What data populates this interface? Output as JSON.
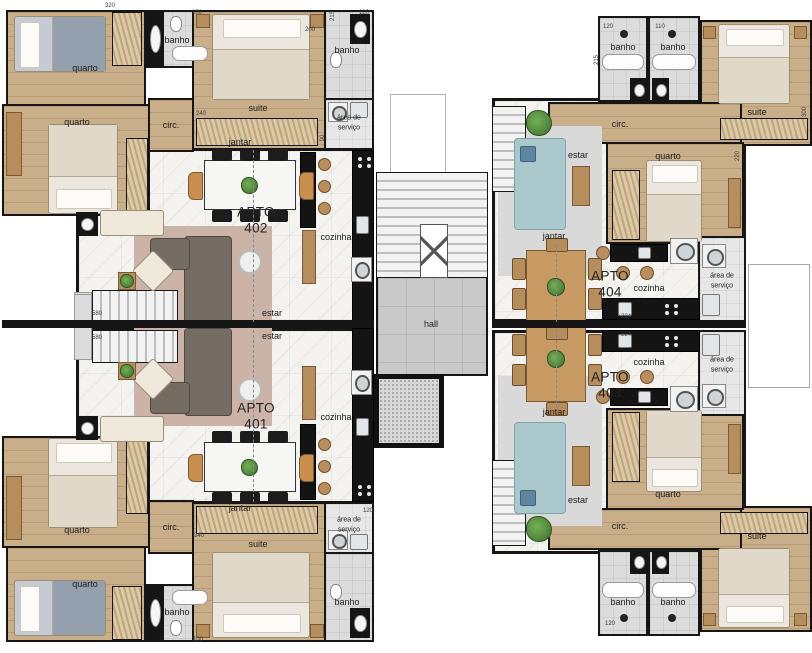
{
  "labels": {
    "quarto": "quarto",
    "banho": "banho",
    "suite": "suite",
    "circ": "circ.",
    "jantar": "jantar",
    "cozinha": "cozinha",
    "estar": "estar",
    "servico1": "área de",
    "servico2": "serviço",
    "hall": "hall",
    "apto": "APTO"
  },
  "apartments": [
    {
      "label": "APTO",
      "number": "402"
    },
    {
      "label": "APTO",
      "number": "401"
    },
    {
      "label": "APTO",
      "number": "404"
    },
    {
      "label": "APTO",
      "number": "403"
    }
  ],
  "dims": [
    "320",
    "100",
    "200",
    "215",
    "120",
    "240",
    "90",
    "580",
    "580",
    "340",
    "120",
    "100",
    "120",
    "110",
    "215",
    "300",
    "220",
    "224",
    "224",
    "120"
  ],
  "colors": {
    "wall": "#161616",
    "wood_floor": "#c9ae8a",
    "marble_floor": "#f4f3f0",
    "bath_tile": "#dcdcdc",
    "counter_black": "#141414",
    "sofa_dark": "#756d64",
    "sofa_blue": "#abc9cc",
    "rug_pink": "#ccb3a8",
    "hall_floor": "#c9c9c9",
    "plant_green": "#4e8040"
  }
}
